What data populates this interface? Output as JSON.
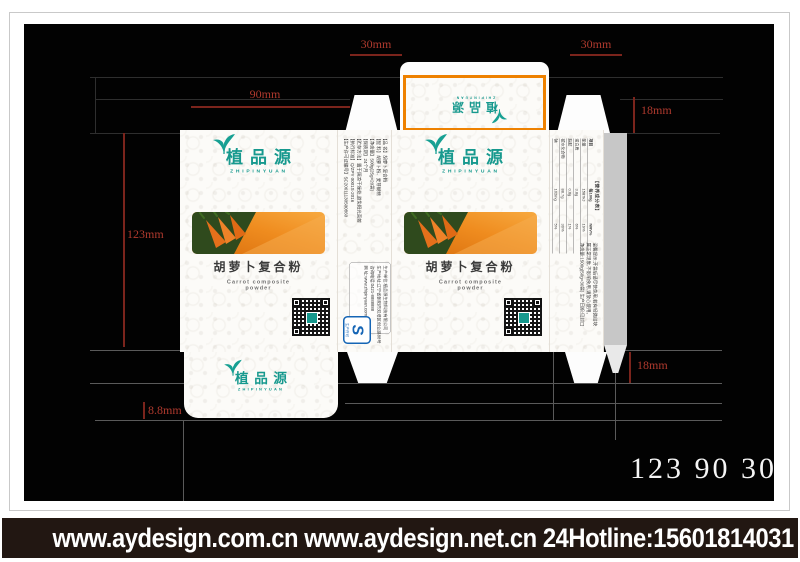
{
  "annotations": {
    "top_left_width": "30mm",
    "top_right_width": "30mm",
    "panel_width": "90mm",
    "panel_height": "123mm",
    "top_depth": "18mm",
    "bottom_depth": "18mm",
    "glue_margin": "8.8mm",
    "size_summary": "123 90 30"
  },
  "brand": {
    "name_cn": "植品源",
    "name_en": "ZHIPINYUAN"
  },
  "product": {
    "title_cn": "胡萝卜复合粉",
    "title_en": "Carrot composite powder"
  },
  "side_info": {
    "lines": [
      "【品 名】胡萝卜复合粉",
      "【配 料】胡萝卜粉、麦芽糊精",
      "【净含量】500g(25g×20袋)",
      "【保质期】24个月",
      "【贮存方法】置于阴凉干燥处,避免阳光直射",
      "【执行标准】Q/ZPY 0001S-2016",
      "【生产许可证编号】SC20611130500860"
    ]
  },
  "company": {
    "lines": [
      "生产单位:植品源生物科技有限公司",
      "生产地址:辽宁省朝阳市双塔区创业路88号",
      "咨询电话:0421-8888888",
      "网 址:www.zhipinyuan.com"
    ]
  },
  "qs": {
    "s": "S",
    "label": "生产许可"
  },
  "nutrition": {
    "title": "【营养成分表】",
    "headers": [
      "项目",
      "每100g",
      "NRV%"
    ],
    "rows": [
      [
        "能量",
        "1587kJ",
        "19%"
      ],
      [
        "蛋白质",
        "3.8g",
        "6%"
      ],
      [
        "脂肪",
        "0.6g",
        "1%"
      ],
      [
        "碳水化合物",
        "88.7g",
        "30%"
      ],
      [
        "钠",
        "102mg",
        "5%"
      ]
    ]
  },
  "notes": {
    "lines": [
      "温馨提示:开袋后请尽快食用,若有轻微结块",
      "属正常现象,不影响食用,请放心使用。",
      "净含量:1500g(50g×30袋) 生产日期:见封口"
    ]
  },
  "footer": {
    "text": "www.aydesign.com.cn www.aydesign.net.cn 24Hotline:15601814031"
  },
  "colors": {
    "accent_orange": "#ee8100",
    "brand_teal": "#17998e",
    "dim_red": "#b03a2e"
  }
}
